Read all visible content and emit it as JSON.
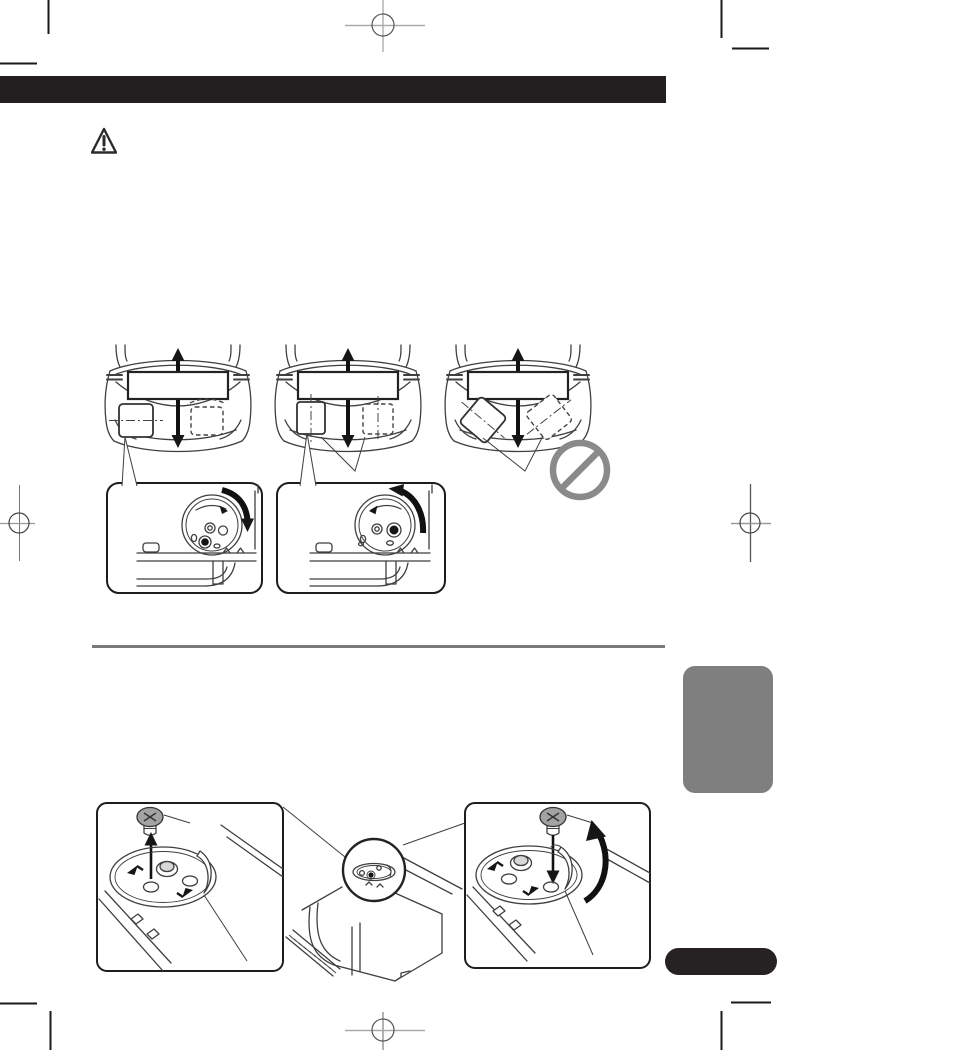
{
  "document": {
    "kind": "printed-instruction-manual-page",
    "visible_text_strings": [],
    "sections": {
      "top_figure": {
        "car_top_views": 3,
        "allowed_positions_callout_boxes": 2,
        "forbidden_orientation_marked": true
      },
      "bottom_figure": {
        "screw_remove_box": 1,
        "screw_insert_box": 1,
        "magnified_unit_view": 1
      }
    }
  },
  "colors": {
    "paper": "#ffffff",
    "ink": "#2b2b2b",
    "header_bar": "#231f20",
    "divider": "#7a7a7a",
    "chapter_tab": "#7f7f7f",
    "page_pill": "#262223",
    "prohibition": "#8a8a8a",
    "screw_fill": "#a3a3a3",
    "registration_mark": "#8c8c8c"
  },
  "icons": {
    "warning-icon": "outlined triangle with exclamation mark",
    "prohibition-icon": "gray circle with diagonal slash",
    "screw-icon": "cross-slot machine screw",
    "up-arrow-icon": "arrow pointing up (remove screw)",
    "down-arrow-icon": "arrow pointing down (insert screw)",
    "updown-arrow-icon": "double-headed vertical arrow through head unit",
    "rotate-cw-arrow-icon": "thick clockwise curved arrow",
    "rotate-ccw-arrow-icon": "thick counterclockwise curved arrow",
    "magnifier-circle": "detail-magnifying circle over unit top",
    "registration-mark": "printer crosshair registration target",
    "trim-mark": "printer corner trim line"
  }
}
